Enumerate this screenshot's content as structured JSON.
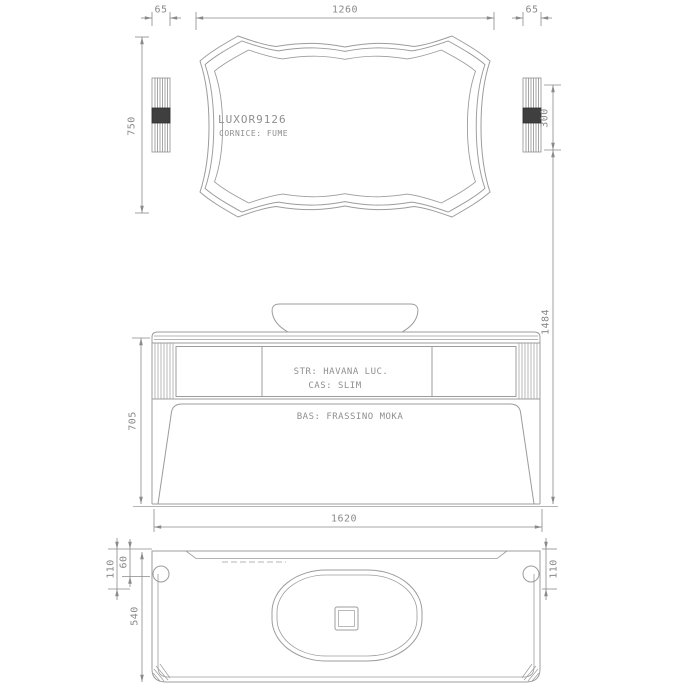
{
  "drawing": {
    "title_model": "LUXOR9126",
    "mirror_view": {
      "model": "LUXOR9126",
      "frame_finish": "CORNICE: FUME",
      "dims": {
        "side_left": "65",
        "width": "1260",
        "side_right": "65",
        "height": "750",
        "sconce_height": "300"
      }
    },
    "front_view": {
      "structure": "STR: HAVANA LUC.",
      "drawers": "CAS: SLIM",
      "base": "BAS: FRASSINO MOKA",
      "dims": {
        "cabinet_height": "705",
        "width": "1620",
        "total_height": "1484"
      }
    },
    "plan_view": {
      "dims": {
        "back_offset": "110",
        "groove_offset": "60",
        "depth": "540",
        "right_offset": "110"
      }
    }
  },
  "colors": {
    "background": "#ffffff",
    "line": "#9c9c9c",
    "dimension": "#8a8a8a",
    "text": "#8f8f8f",
    "sconce_band": "#3f3f3f"
  }
}
